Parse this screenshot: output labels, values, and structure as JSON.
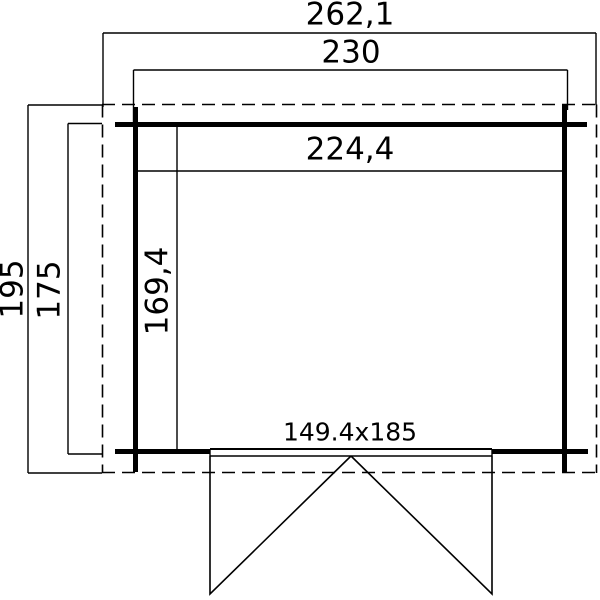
{
  "plan": {
    "labels": {
      "outer_width": "262,1",
      "frame_width": "230",
      "inner_width": "224,4",
      "outer_depth": "195",
      "frame_depth": "175",
      "inner_depth": "169,4",
      "door": "149.4x185"
    },
    "colors": {
      "line": "#000000",
      "background": "#ffffff"
    }
  }
}
